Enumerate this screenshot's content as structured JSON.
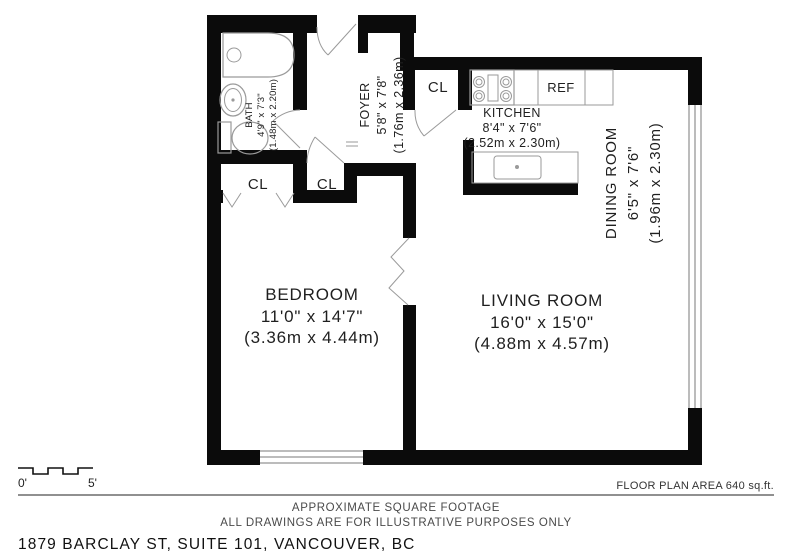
{
  "title": "Floor plan — 1879 Barclay St, Suite 101",
  "rooms": {
    "bath": {
      "name": "BATH",
      "dims_ft": "4'9\" x 7'3\"",
      "dims_m": "(1.48m x 2.20m)"
    },
    "foyer": {
      "name": "FOYER",
      "dims_ft": "5'8\" x 7'8\"",
      "dims_m": "(1.76m x 2.36m)"
    },
    "kitchen": {
      "name": "KITCHEN",
      "dims_ft": "8'4\" x 7'6\"",
      "dims_m": "(2.52m x 2.30m)"
    },
    "dining": {
      "name": "DINING ROOM",
      "dims_ft": "6'5\" x 7'6\"",
      "dims_m": "(1.96m x 2.30m)"
    },
    "bedroom": {
      "name": "BEDROOM",
      "dims_ft": "11'0\" x 14'7\"",
      "dims_m": "(3.36m x 4.44m)"
    },
    "living": {
      "name": "LIVING ROOM",
      "dims_ft": "16'0\" x 15'0\"",
      "dims_m": "(4.88m x 4.57m)"
    }
  },
  "labels": {
    "closet": "CL",
    "fridge": "REF"
  },
  "scale": {
    "start": "0'",
    "end": "5'"
  },
  "footer": {
    "area_note": "FLOOR PLAN AREA 640 sq.ft.",
    "note1": "APPROXIMATE SQUARE FOOTAGE",
    "note2": "ALL DRAWINGS ARE FOR ILLUSTRATIVE PURPOSES ONLY",
    "address": "1879 BARCLAY ST, SUITE 101, VANCOUVER, BC"
  },
  "colors": {
    "wall": "#0b0b0b",
    "fixture_stroke": "#9a9a9a",
    "text": "#1f1f1f",
    "note_text": "#4a4a4a"
  }
}
